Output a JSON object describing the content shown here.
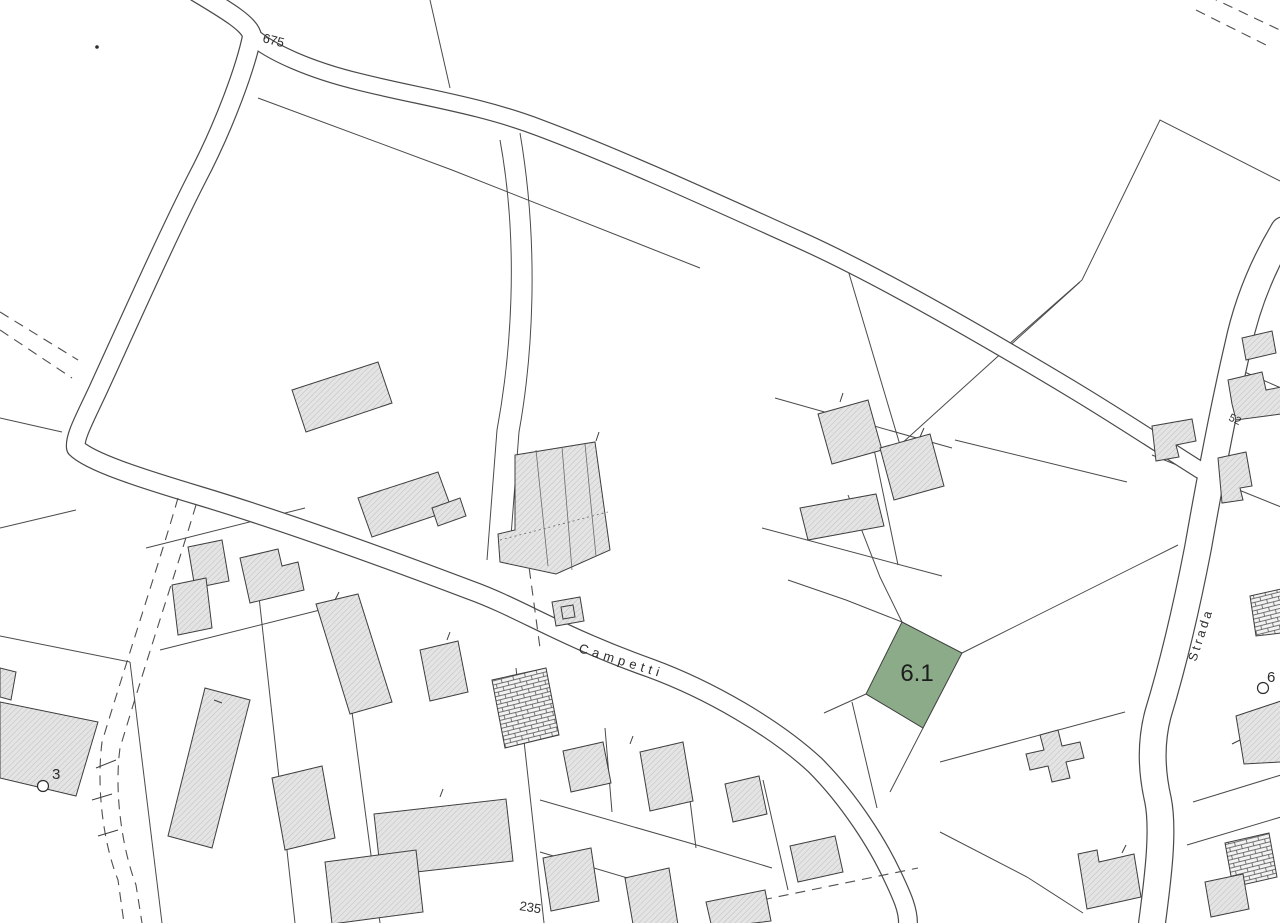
{
  "map": {
    "background_color": "#ffffff",
    "line_color": "#4a4a4a",
    "building_fill": "#e4e4e4",
    "building_hatch": "#bfbfbf",
    "highlight_parcel": {
      "id": "6.1",
      "fill": "#8bab89",
      "label": "6.1"
    },
    "labels": {
      "road_number_top": "675",
      "street_campetti": "Campetti",
      "street_strada": "Strada",
      "parcel_highlight": "6.1",
      "survey_point_left": "3",
      "survey_point_right": "6",
      "parcel_number_bottom": "235",
      "parcel_number_right": "52"
    }
  }
}
